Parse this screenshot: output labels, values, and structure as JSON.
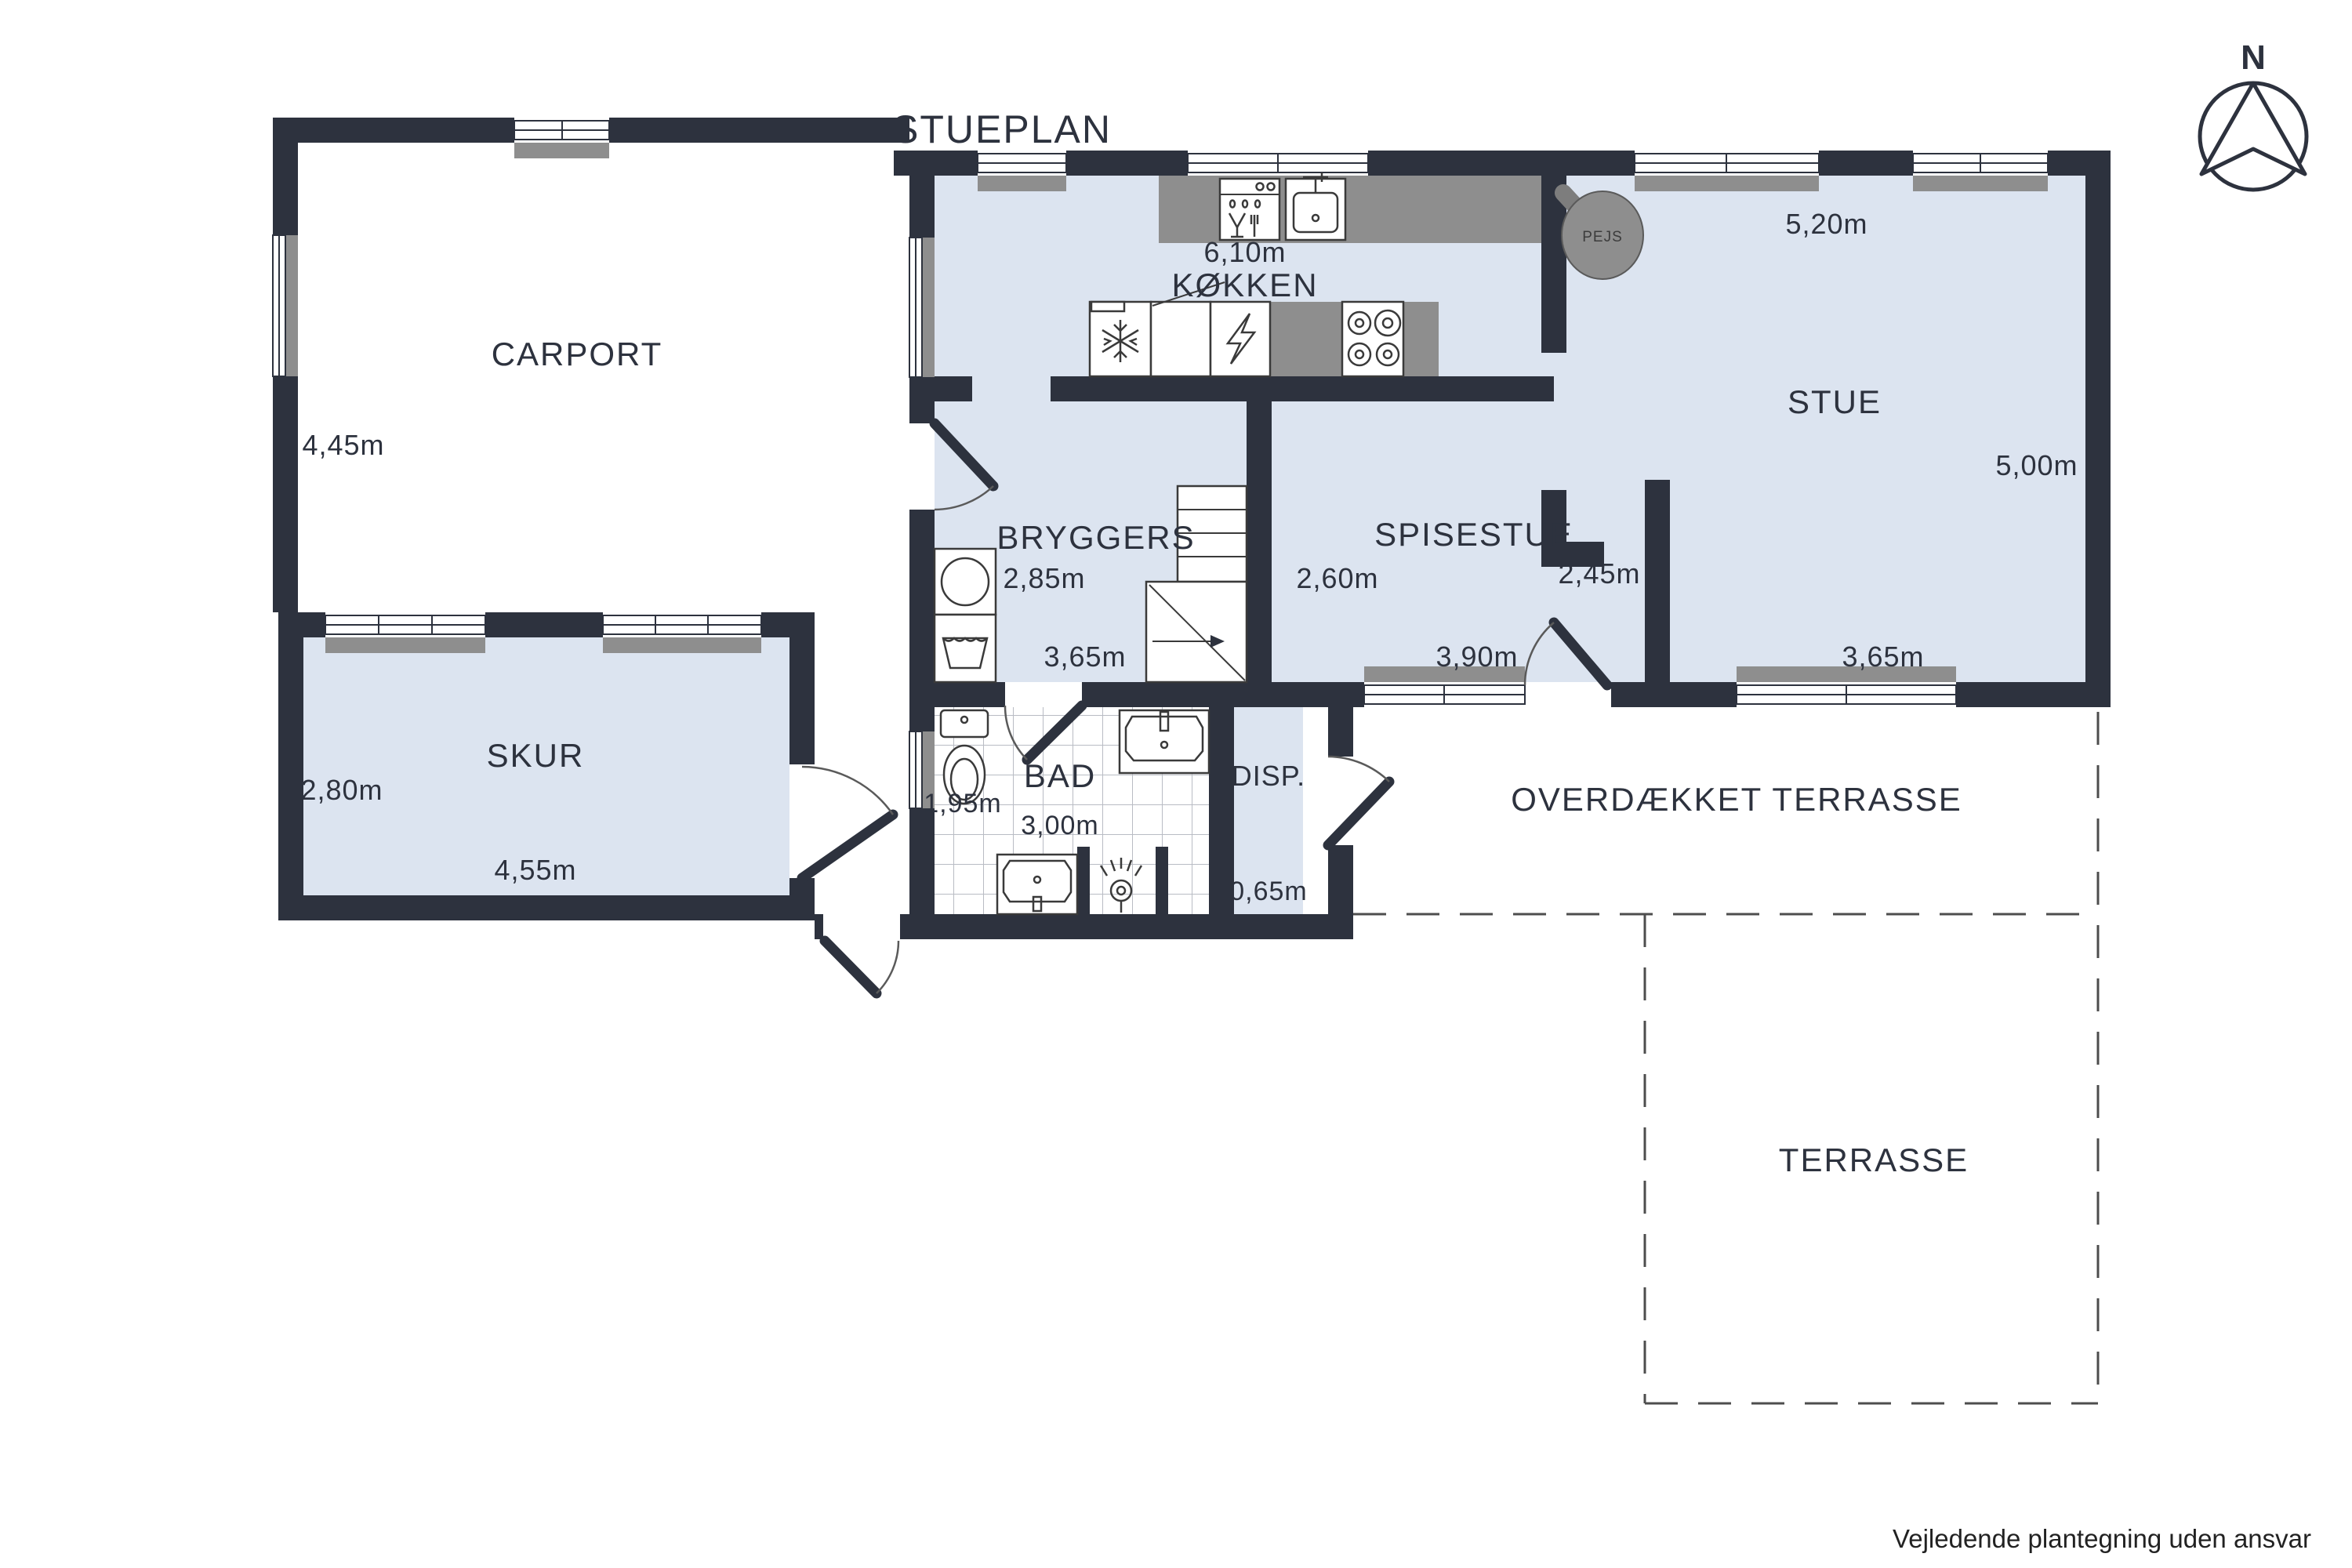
{
  "title": "STUEPLAN",
  "compass": {
    "label": "N"
  },
  "fireplace": {
    "label": "PEJS"
  },
  "rooms": {
    "carport": {
      "label": "CARPORT",
      "height": "4,45m"
    },
    "skur": {
      "label": "SKUR",
      "height": "2,80m",
      "width": "4,55m"
    },
    "kokken": {
      "label": "KØKKEN",
      "width": "6,10m"
    },
    "stue": {
      "label": "STUE",
      "width_top": "5,20m",
      "height": "5,00m",
      "width_bottom": "3,65m"
    },
    "bryggers": {
      "label": "BRYGGERS",
      "height": "2,85m",
      "width": "3,65m"
    },
    "spisestue": {
      "label": "SPISESTUE",
      "height_left": "2,60m",
      "height_right": "2,45m",
      "width": "3,90m"
    },
    "bad": {
      "label": "BAD",
      "height": "1,95m",
      "width": "3,00m"
    },
    "disp": {
      "label": "DISP.",
      "width": "0,65m"
    },
    "overdaekket_terrasse": {
      "label": "OVERDÆKKET TERRASSE"
    },
    "terrasse": {
      "label": "TERRASSE"
    }
  },
  "footer": {
    "disclaimer": "Vejledende plantegning uden ansvar"
  },
  "colors": {
    "wall": "#2d323e",
    "room_fill": "#dce4f0",
    "counter_gray": "#8e8e8e",
    "background": "#ffffff",
    "dashed_line": "#4d4d4d"
  },
  "icons": {
    "compass-icon": "circle with north arrow",
    "fireplace-icon": "gray circle with flue",
    "fridge-icon": "snowflake",
    "oven-icon": "lightning bolt",
    "stove-icon": "four burners",
    "dishwasher-icon": "glass and fork with drops",
    "kitchen-sink-icon": "basin with faucet",
    "washing-machine-icon": "circle drum",
    "laundry-sink-icon": "basin with wave",
    "toilet-icon": "cistern and bowl",
    "bath-sink-icon": "vanity basin",
    "shower-icon": "shower head with spray",
    "stairs-icon": "treads with up arrow"
  }
}
